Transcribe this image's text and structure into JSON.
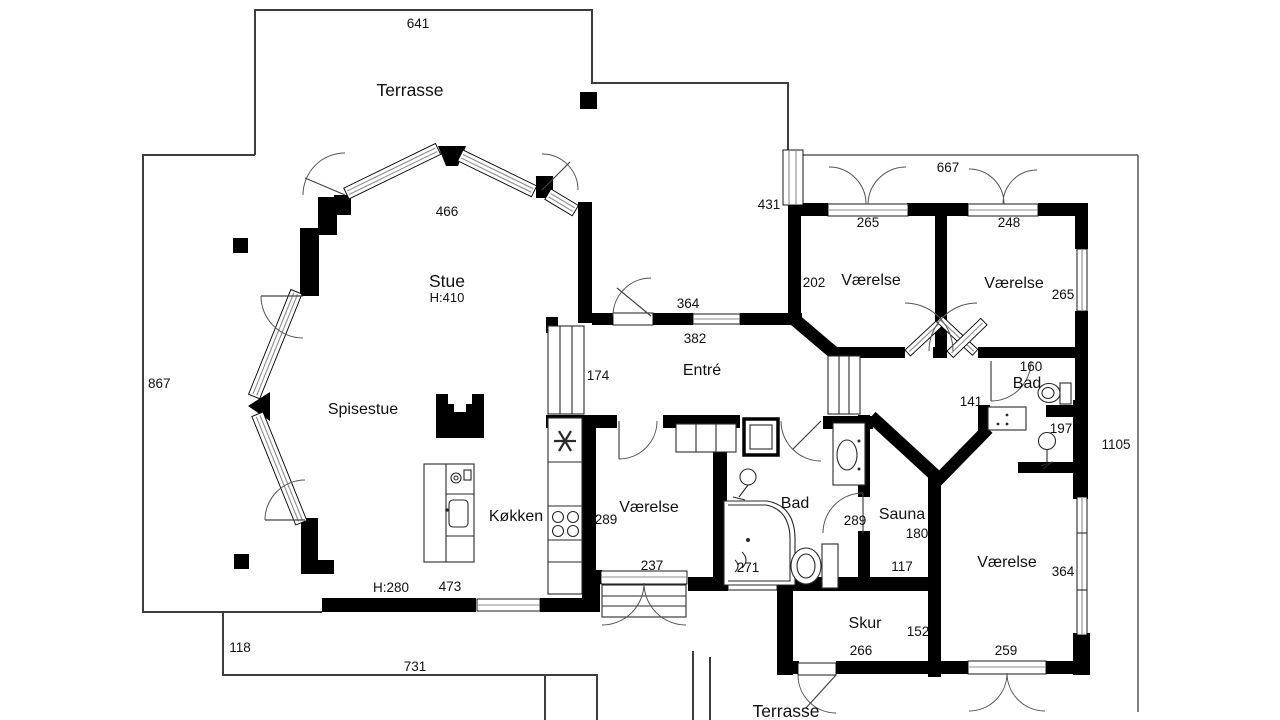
{
  "plan": {
    "areas": {
      "terrasse_top": {
        "label": "Terrasse"
      },
      "stue": {
        "label": "Stue",
        "height_note": "H:410"
      },
      "spisestue": {
        "label": "Spisestue"
      },
      "kokken": {
        "label": "Køkken",
        "height_note": "H:280"
      },
      "entre": {
        "label": "Entré"
      },
      "vaerelse_nw": {
        "label": "Værelse"
      },
      "vaerelse_ne": {
        "label": "Værelse"
      },
      "bad_ne": {
        "label": "Bad"
      },
      "vaerelse_mid": {
        "label": "Værelse"
      },
      "bad_mid": {
        "label": "Bad"
      },
      "sauna": {
        "label": "Sauna"
      },
      "vaerelse_se": {
        "label": "Værelse"
      },
      "skur": {
        "label": "Skur"
      },
      "terrasse_bottom": {
        "label": "Terrasse"
      }
    },
    "dimensions": {
      "d641": "641",
      "d466": "466",
      "d867": "867",
      "d431": "431",
      "d667": "667",
      "d265_nw": "265",
      "d248": "248",
      "d202": "202",
      "d265_ne": "265",
      "d364_entre": "364",
      "d382": "382",
      "d174": "174",
      "d160": "160",
      "d141": "141",
      "d197": "197",
      "d1105": "1105",
      "d289_vm": "289",
      "d237": "237",
      "d271": "271",
      "d289_bad": "289",
      "d180": "180",
      "d117": "117",
      "d364_se": "364",
      "d473": "473",
      "d118": "118",
      "d731": "731",
      "d152": "152",
      "d266": "266",
      "d259": "259"
    },
    "colors": {
      "wall": "#000000",
      "site_line": "#3d3d3d",
      "glass": "#8d8d8d",
      "paper": "#ffffff"
    }
  }
}
